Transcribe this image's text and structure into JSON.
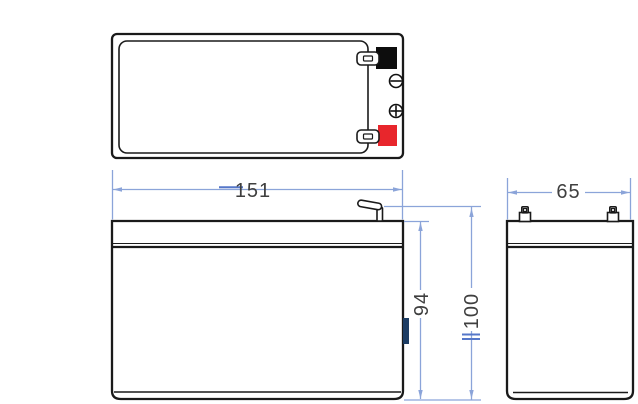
{
  "drawing": {
    "dimensions": {
      "overall_length": "151",
      "container_height": "94",
      "total_height": "100",
      "width": "65"
    },
    "icons": {
      "negative_terminal": "minus-circle-icon",
      "positive_terminal": "plus-circle-icon"
    },
    "colors": {
      "outline": "#1a1a1a",
      "dimension_line": "#8ba4d9",
      "dimension_tick": "#5577c9",
      "dimension_text": "#3f3f3f",
      "negative_terminal": "#0d0d0d",
      "positive_terminal": "#e8262c",
      "side_label_tab": "#1c3c63",
      "background": "#ffffff"
    }
  }
}
